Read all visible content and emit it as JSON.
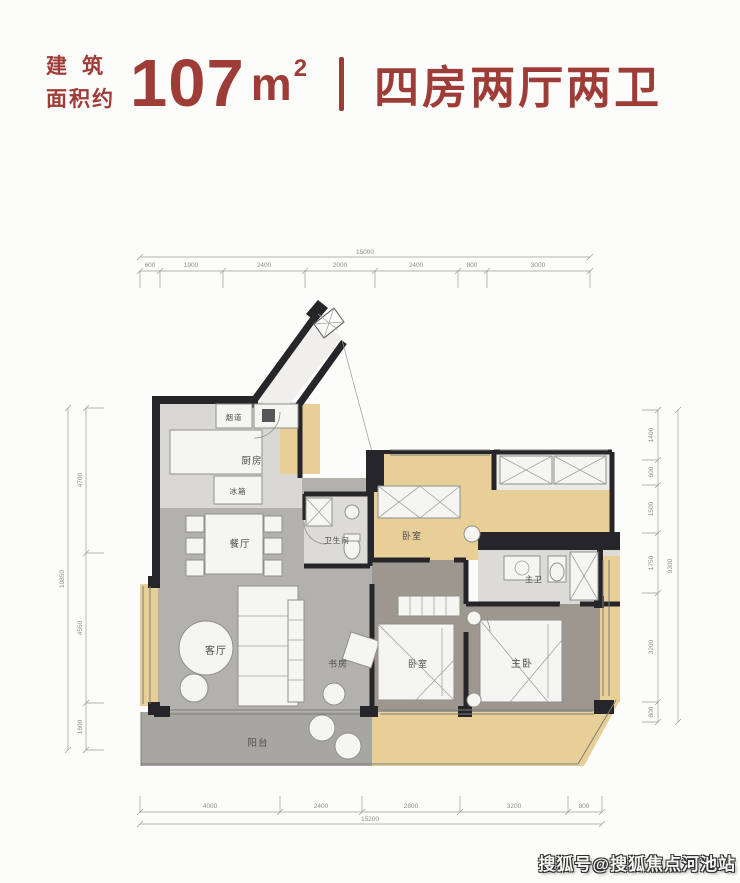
{
  "header": {
    "prefix_line1": "建筑",
    "prefix_line2": "面积约",
    "area_number": "107",
    "area_unit": "m",
    "area_exponent": "2",
    "layout_text": "四房两厅两卫",
    "accent_color": "#9e3c38"
  },
  "floorplan": {
    "rooms": {
      "flue": "烟道",
      "kitchen": "厨房",
      "fridge": "冰箱",
      "dining": "餐厅",
      "bathroom": "卫生间",
      "bedroom_top": "卧室",
      "master_bath": "主卫",
      "living": "客厅",
      "study": "书房",
      "bedroom_bottom": "卧室",
      "master_bedroom": "主卧",
      "balcony": "阳台"
    },
    "dimensions": {
      "top": {
        "total": "15000",
        "segments": [
          "600",
          "1900",
          "2400",
          "2000",
          "2400",
          "800",
          "3000"
        ]
      },
      "bottom": {
        "total": "15200",
        "segments": [
          "4000",
          "2400",
          "2800",
          "3200",
          "800"
        ]
      },
      "left": {
        "total": "10850",
        "segments": [
          "4700",
          "4550",
          "1600"
        ]
      },
      "right": {
        "total": "9300",
        "segments": [
          "1400",
          "600",
          "1500",
          "1750",
          "3200",
          "800"
        ]
      }
    },
    "colors": {
      "wall": "#26262a",
      "floor_gray": "#b3b1ac",
      "floor_bedroom": "#9d978f",
      "floor_light": "#dbdad6",
      "bay_tan": "#e7cf97",
      "furniture": "#f5f5f2"
    }
  },
  "watermark": {
    "text": "搜狐号@搜狐焦点河池站"
  }
}
